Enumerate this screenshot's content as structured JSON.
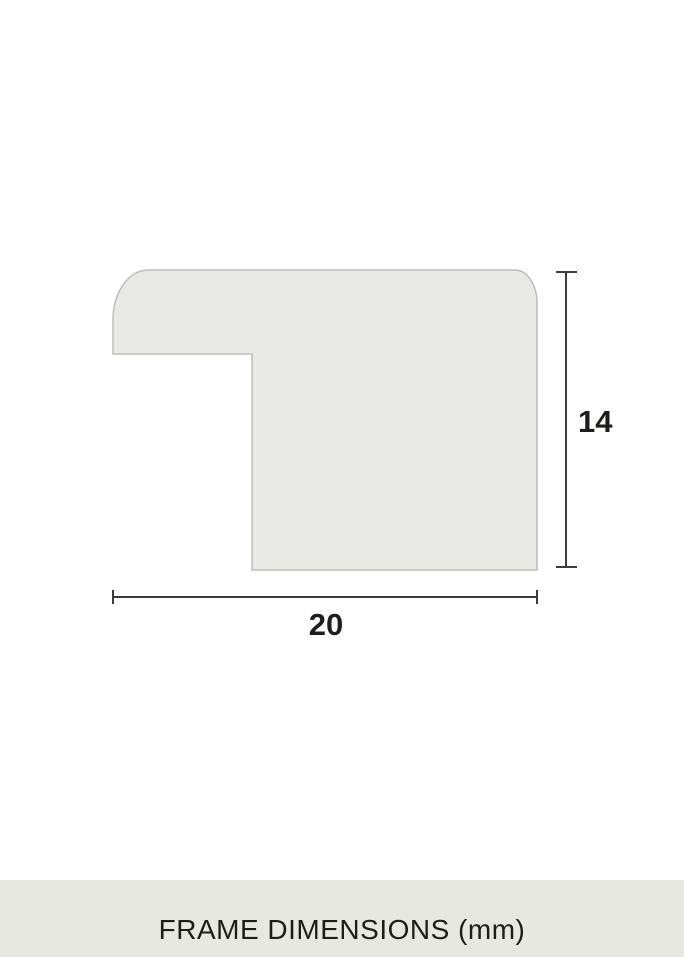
{
  "diagram": {
    "title": "frame moulding cross-section profile",
    "height_label": "14",
    "width_label": "20",
    "unit": "mm"
  },
  "footer": {
    "caption": "FRAME DIMENSIONS (mm)"
  },
  "colors": {
    "shape_fill": "#e9e9e6",
    "shape_stroke": "#bdbdba",
    "dimension_line": "#3c3c3c",
    "text_color": "#1d1d1b",
    "footer_bg": "#e8e8e3",
    "page_bg": "#ffffff"
  }
}
